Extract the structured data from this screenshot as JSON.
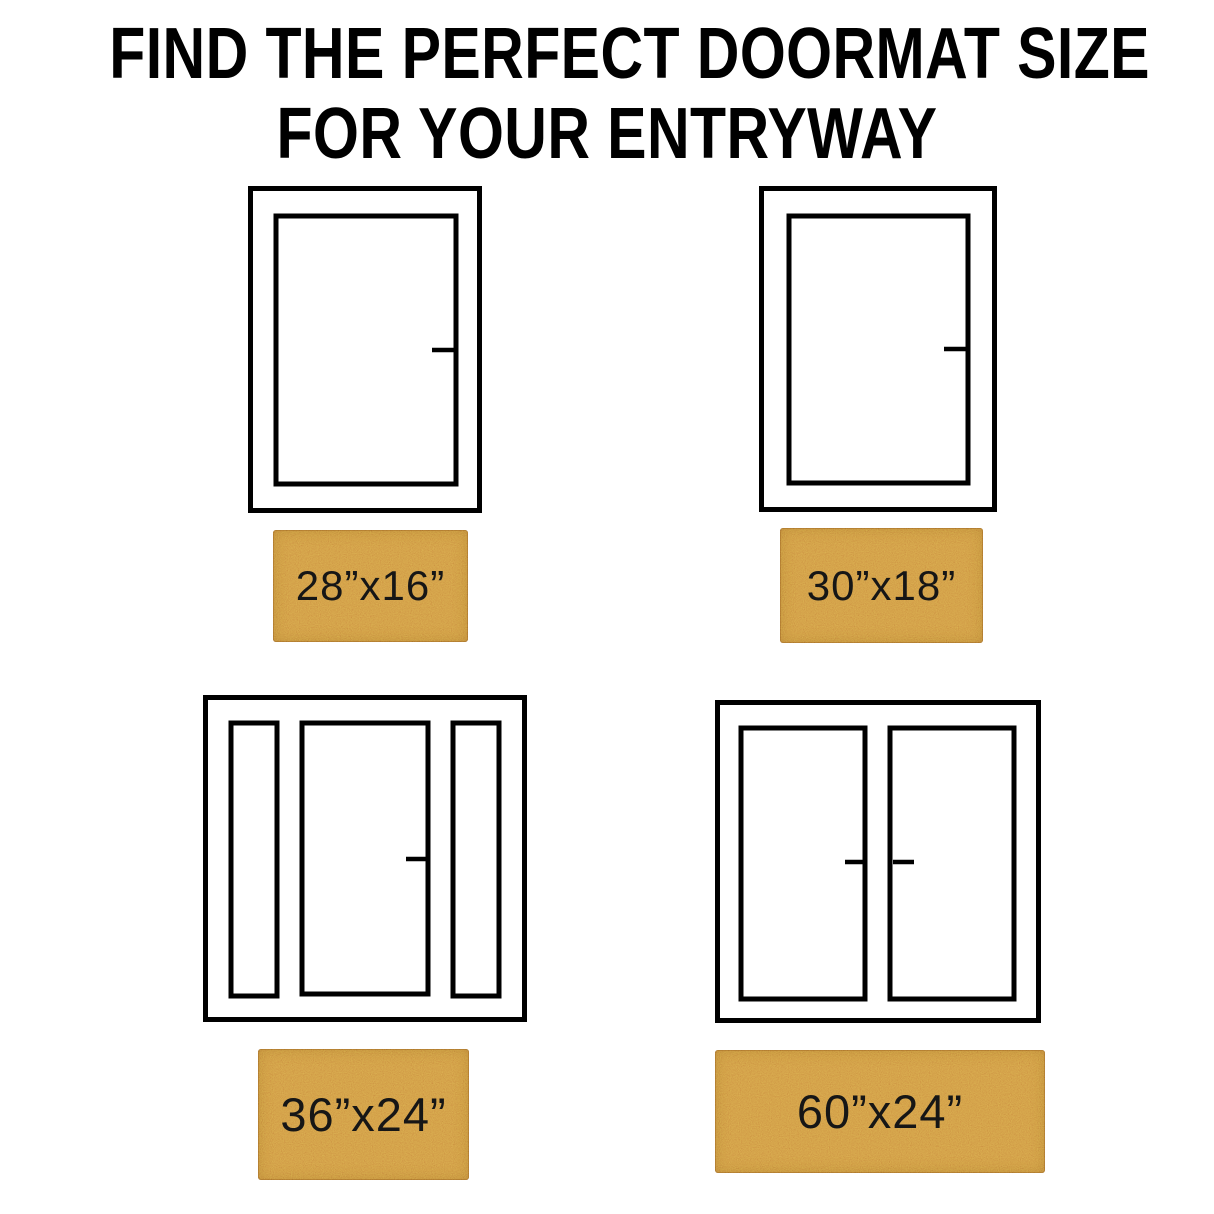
{
  "title": {
    "line1": "FIND THE PERFECT DOORMAT SIZE",
    "line2": "FOR YOUR ENTRYWAY"
  },
  "colors": {
    "background": "#ffffff",
    "outline": "#000000",
    "mat": "#c9893d",
    "label_text": "#161616"
  },
  "doors": [
    {
      "type": "single-door",
      "mat_size": "28”x16”"
    },
    {
      "type": "single-door",
      "mat_size": "30”x18”"
    },
    {
      "type": "door-with-sidelights",
      "mat_size": "36”x24”"
    },
    {
      "type": "double-door",
      "mat_size": "60”x24”"
    }
  ]
}
